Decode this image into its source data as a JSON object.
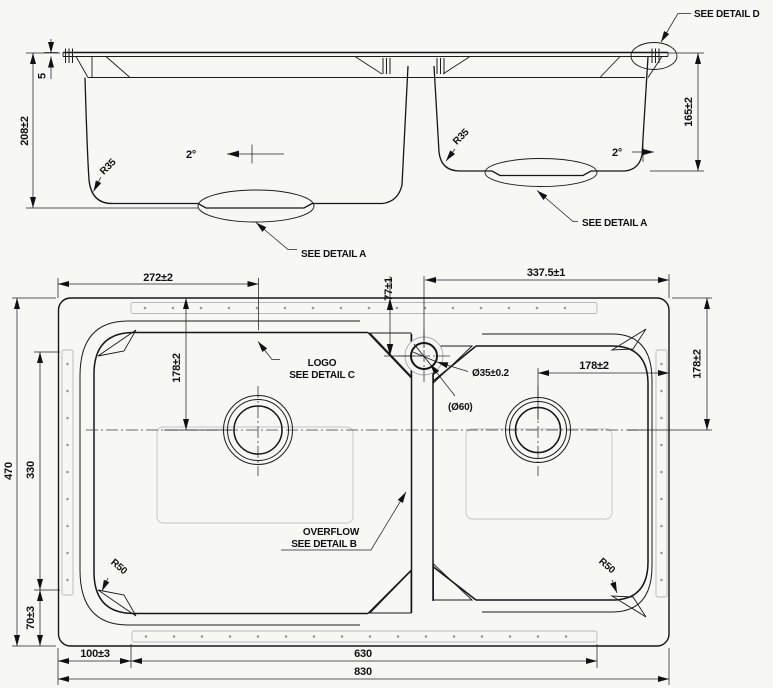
{
  "drawing": {
    "side_view": {
      "dim_rim_height": "5",
      "dim_depth_left": "208±2",
      "dim_depth_right": "165±2",
      "angle_left": "2°",
      "angle_right": "2°",
      "radius_left": "R35",
      "radius_center": "R35",
      "note_detail_d": "SEE DETAIL D",
      "note_detail_a_left": "SEE DETAIL A",
      "note_detail_a_right": "SEE DETAIL A"
    },
    "plan_view": {
      "dim_left_edge_to_drain": "272±2",
      "dim_faucet_offset": "77±1",
      "dim_faucet_to_right_edge": "337.5±1",
      "dim_left_drain_from_top": "178±2",
      "dim_right_drain_to_edge": "178±2",
      "dim_right_drain_from_top": "178±2",
      "dim_overall_depth": "470",
      "dim_groove_span": "330",
      "dim_bottom_corner": "70±3",
      "dim_bottom_left": "100±3",
      "dim_bottom_span": "630",
      "dim_overall_width": "830",
      "faucet_hole_dia": "Ø35±0.2",
      "faucet_boss_dia": "(Ø60)",
      "radius_bottom_left": "R50",
      "radius_bottom_right": "R50",
      "note_logo_1": "LOGO",
      "note_logo_2": "SEE DETAIL C",
      "note_overflow_1": "OVERFLOW",
      "note_overflow_2": "SEE DETAIL B"
    },
    "colors": {
      "line": "#161616",
      "light_line": "#b8b8b8",
      "background": "#f7f7f4"
    }
  }
}
